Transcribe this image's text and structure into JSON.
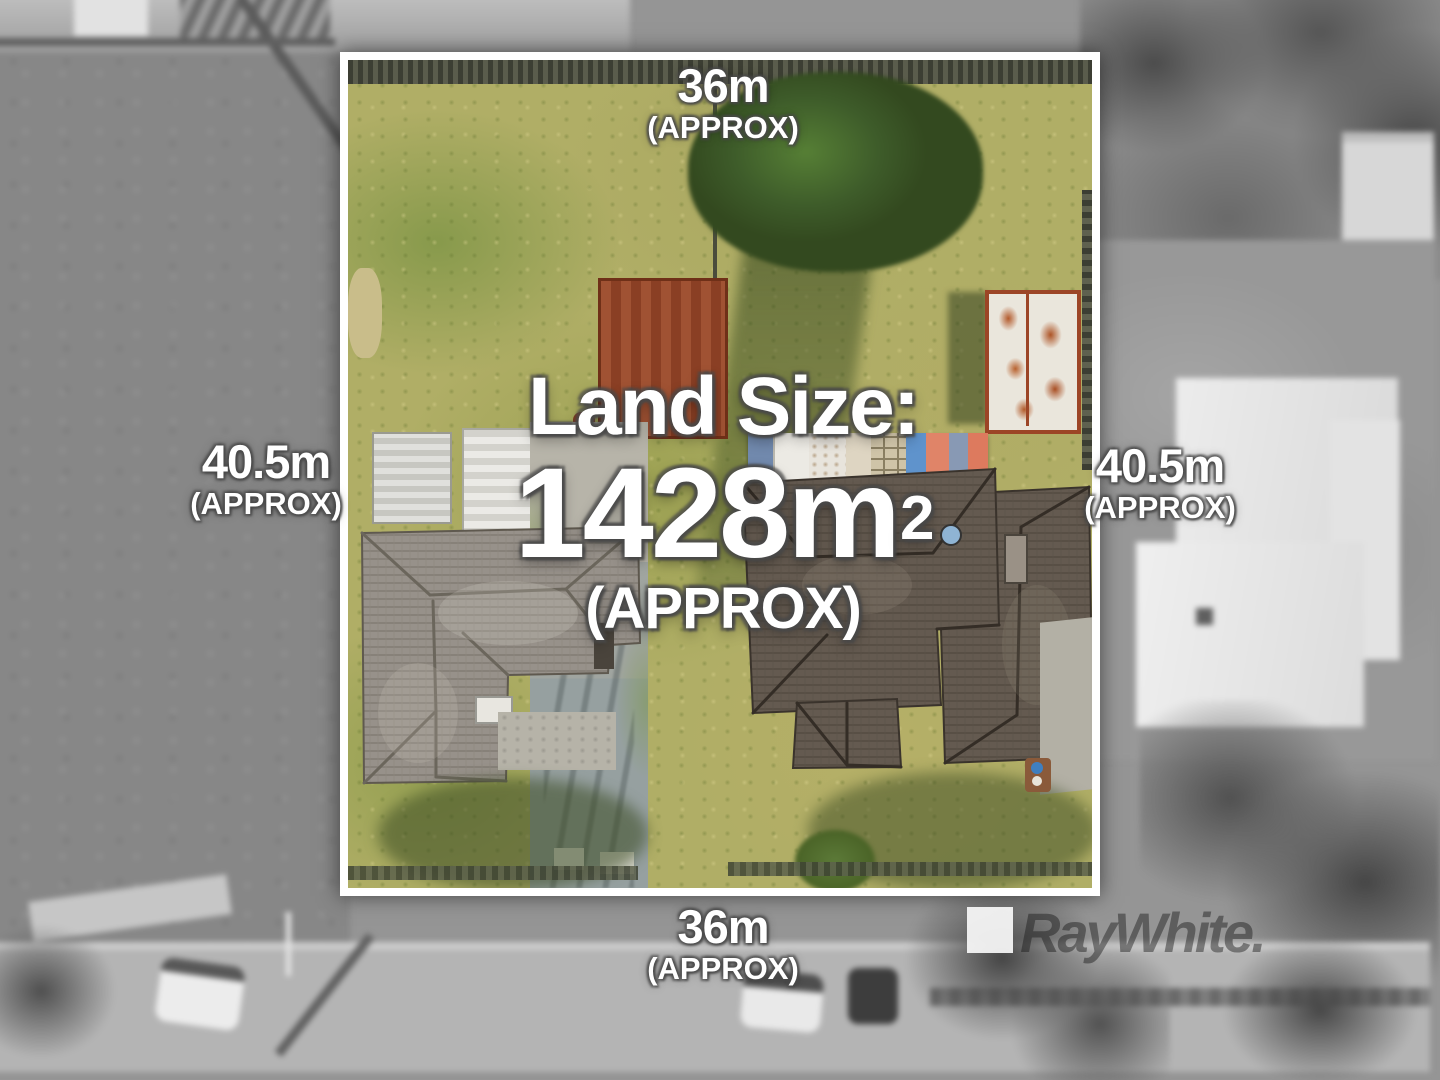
{
  "annotations": {
    "top": {
      "value": "36m",
      "qualifier": "(APPROX)"
    },
    "bottom": {
      "value": "36m",
      "qualifier": "(APPROX)"
    },
    "left": {
      "value": "40.5m",
      "qualifier": "(APPROX)"
    },
    "right": {
      "value": "40.5m",
      "qualifier": "(APPROX)"
    },
    "land_size": {
      "label": "Land Size:",
      "value": "1428m",
      "unit_superscript": "2",
      "qualifier": "(APPROX)"
    }
  },
  "watermark": {
    "brand_text": "RayWhite."
  },
  "colors": {
    "annotation_text": "#ffffff",
    "annotation_outline": "#484848",
    "parcel_border": "#ffffff",
    "grass_base": "#b0ae66",
    "tree_green": "#3e5c2a",
    "red_shed": "#8a3f24",
    "rust_shed": "#b35a2c",
    "left_house_roof": "#97918a",
    "right_house_roof": "#645a50",
    "driveway": "#a0a5a0",
    "background_gray": "#959595",
    "watermark_text": "#2a2a2a"
  }
}
